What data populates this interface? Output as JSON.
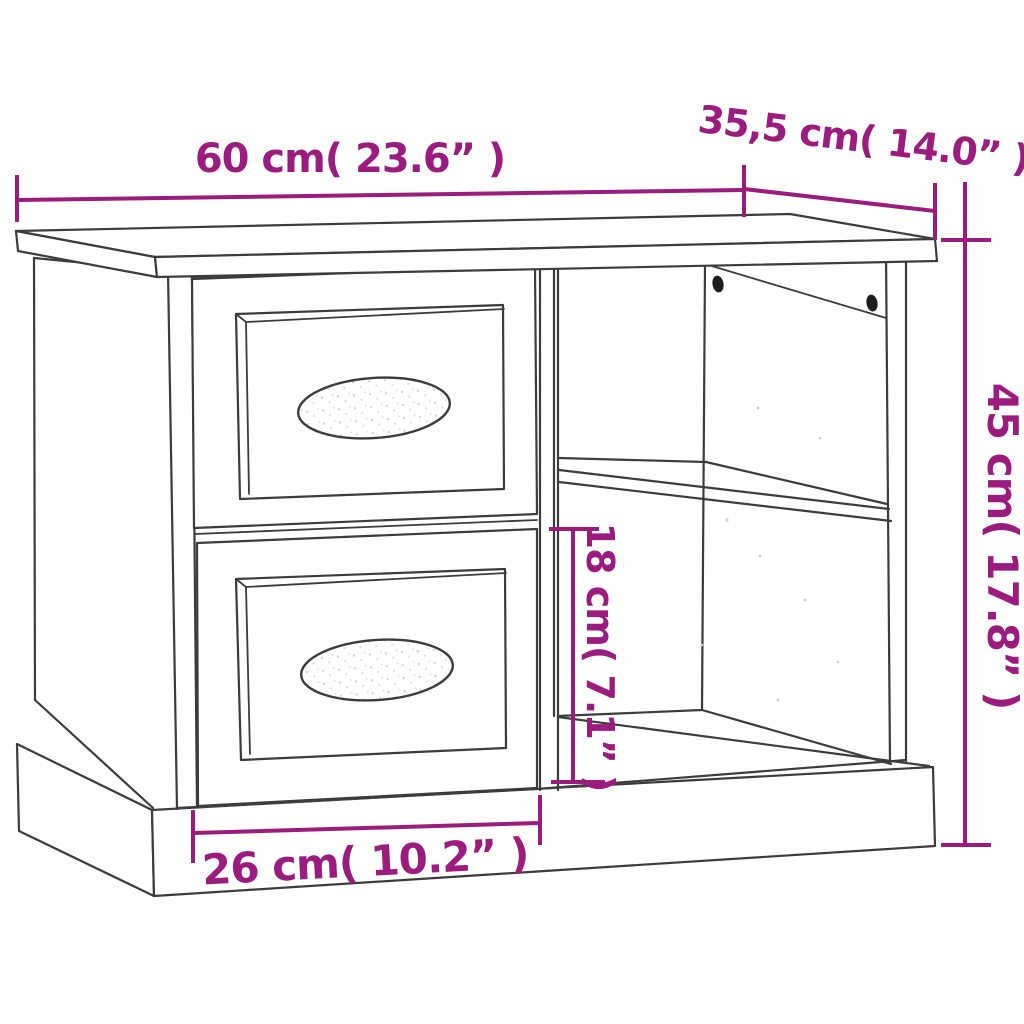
{
  "colors": {
    "dimension_accent": "#9B1B7E",
    "drawing_line": "#3C3C3C",
    "background": "#FFFFFF"
  },
  "dimensions": {
    "width_label": "60 cm( 23.6” )",
    "depth_label": "35,5 cm( 14.0” )",
    "height_label": "45 cm( 17.8” )",
    "compartment_label": "18 cm( 7.1” )",
    "drawer_label": "26 cm( 10.2” )"
  }
}
